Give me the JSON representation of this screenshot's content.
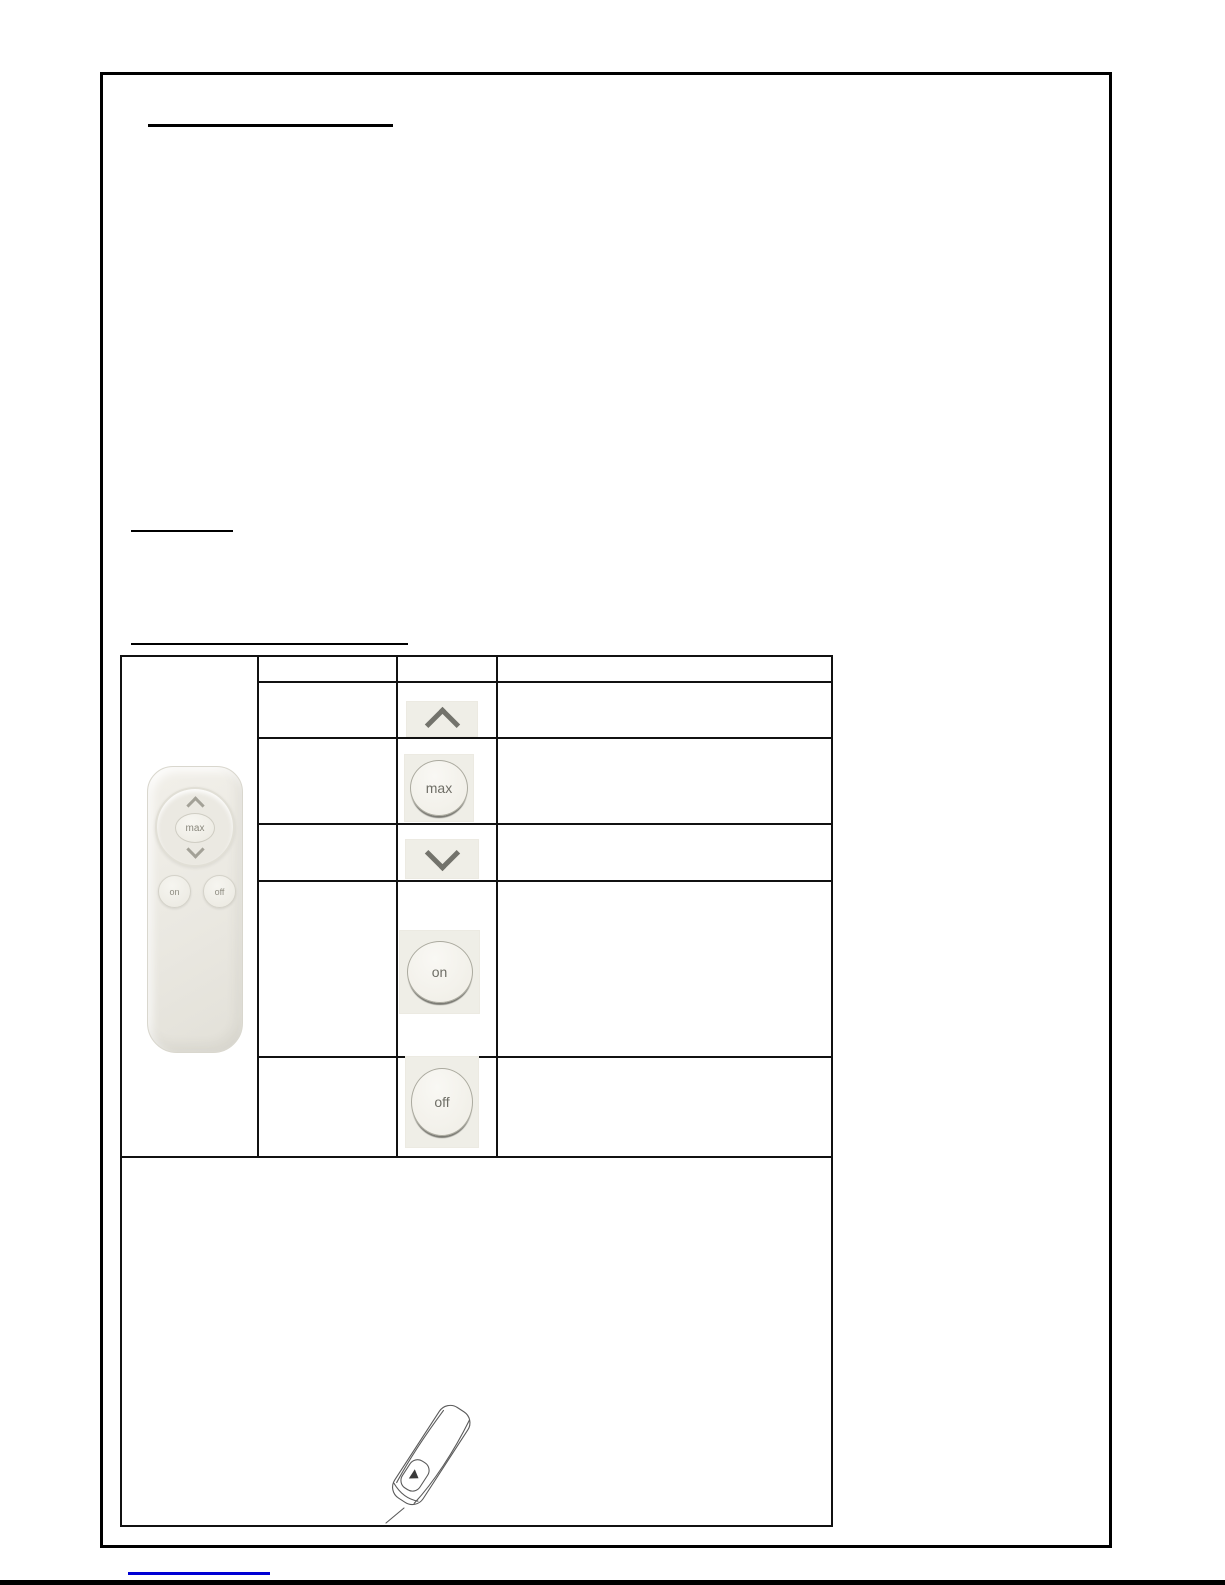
{
  "document": {
    "remote_photo_labels": {
      "max": "max",
      "on": "on",
      "off": "off"
    },
    "table": {
      "rows": [
        {
          "name": "up",
          "icon": "chevron-up-icon",
          "label": ""
        },
        {
          "name": "max",
          "icon": "max-button-icon",
          "label": "max"
        },
        {
          "name": "down",
          "icon": "chevron-down-icon",
          "label": ""
        },
        {
          "name": "on",
          "icon": "on-button-icon",
          "label": "on"
        },
        {
          "name": "off",
          "icon": "off-button-icon",
          "label": "off"
        }
      ]
    },
    "colors": {
      "page_border": "#000000",
      "table_border": "#111111",
      "icon_block_bg": "#efeee7",
      "remote_body": "#eae8e2",
      "button_text": "#6f6e66",
      "link_underline": "#0000d4"
    }
  }
}
